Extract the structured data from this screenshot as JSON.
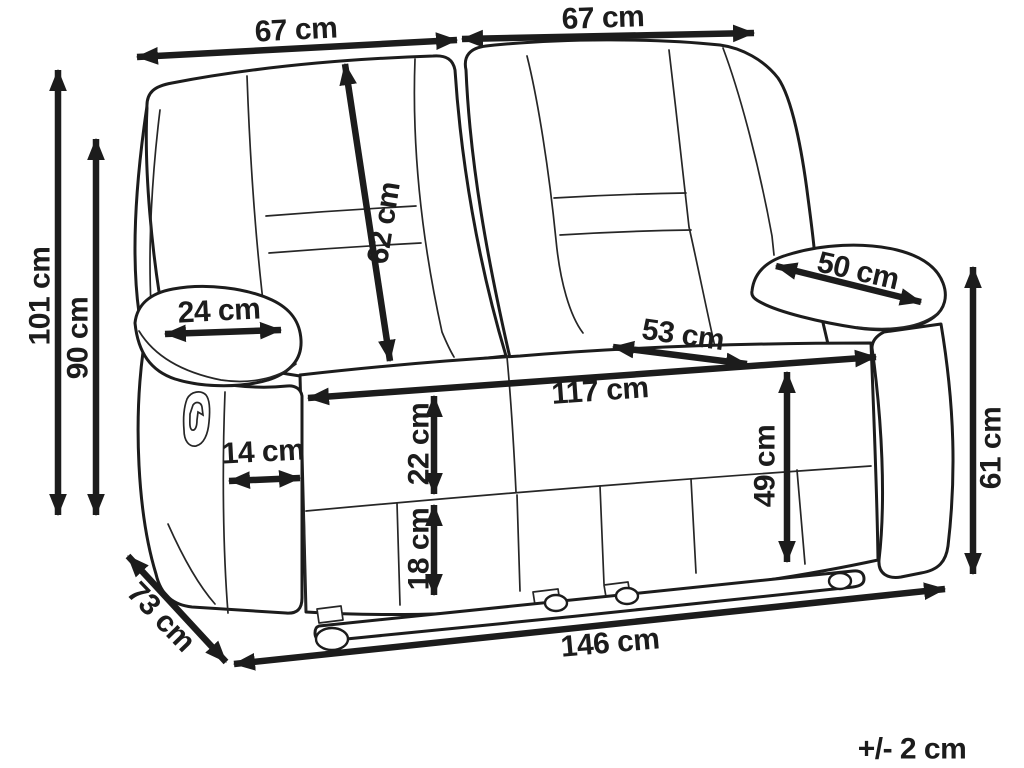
{
  "diagram": {
    "subject": "two-seat recliner sofa dimension drawing",
    "unit": "cm",
    "tolerance_note": "+/- 2 cm",
    "colors": {
      "background": "#ffffff",
      "line": "#1c1c1c"
    },
    "dimensions": [
      {
        "name": "backrest-width-left",
        "label": "67 cm",
        "value": 67,
        "arrow": [
          137,
          57,
          457,
          40
        ],
        "text": [
          296,
          30
        ],
        "rot": -3
      },
      {
        "name": "backrest-width-right",
        "label": "67 cm",
        "value": 67,
        "arrow": [
          462,
          39,
          754,
          33
        ],
        "text": [
          603,
          18
        ],
        "rot": -2
      },
      {
        "name": "total-height",
        "label": "101 cm",
        "value": 101,
        "arrow": [
          58,
          70,
          58,
          515
        ],
        "text": [
          40,
          296
        ],
        "rot": -90
      },
      {
        "name": "backrest-height",
        "label": "90 cm",
        "value": 90,
        "arrow": [
          96,
          139,
          96,
          515
        ],
        "text": [
          78,
          338
        ],
        "rot": -90
      },
      {
        "name": "backrest-cushion-length",
        "label": "62 cm",
        "value": 62,
        "arrow": [
          345,
          64,
          390,
          361
        ],
        "text": [
          384,
          223
        ],
        "rot": -81
      },
      {
        "name": "armrest-pad-width",
        "label": "24 cm",
        "value": 24,
        "arrow": [
          165,
          334,
          281,
          330
        ],
        "text": [
          219,
          311
        ],
        "rot": -3
      },
      {
        "name": "armrest-pad-length",
        "label": "50 cm",
        "value": 50,
        "arrow": [
          776,
          266,
          921,
          302
        ],
        "text": [
          858,
          271
        ],
        "rot": 13
      },
      {
        "name": "seat-depth",
        "label": "53 cm",
        "value": 53,
        "arrow": [
          613,
          347,
          747,
          364
        ],
        "text": [
          683,
          335
        ],
        "rot": 8
      },
      {
        "name": "seat-width",
        "label": "117 cm",
        "value": 117,
        "arrow": [
          308,
          398,
          876,
          357
        ],
        "text": [
          600,
          391
        ],
        "rot": -4
      },
      {
        "name": "seat-height",
        "label": "49 cm",
        "value": 49,
        "arrow": [
          787,
          372,
          787,
          562
        ],
        "text": [
          765,
          466
        ],
        "rot": -90
      },
      {
        "name": "armrest-height",
        "label": "61 cm",
        "value": 61,
        "arrow": [
          973,
          267,
          973,
          574
        ],
        "text": [
          991,
          448
        ],
        "rot": -90
      },
      {
        "name": "seat-cushion-height",
        "label": "22 cm",
        "value": 22,
        "arrow": [
          434,
          396,
          434,
          494
        ],
        "text": [
          419,
          444
        ],
        "rot": -90
      },
      {
        "name": "base-height",
        "label": "18 cm",
        "value": 18,
        "arrow": [
          434,
          505,
          434,
          595
        ],
        "text": [
          419,
          549
        ],
        "rot": -90
      },
      {
        "name": "armrest-front-width",
        "label": "14 cm",
        "value": 14,
        "arrow": [
          229,
          481,
          300,
          478
        ],
        "text": [
          263,
          452
        ],
        "rot": -3
      },
      {
        "name": "overall-depth",
        "label": "73 cm",
        "value": 73,
        "arrow": [
          128,
          556,
          226,
          662
        ],
        "text": [
          161,
          617
        ],
        "rot": 46
      },
      {
        "name": "overall-width",
        "label": "146 cm",
        "value": 146,
        "arrow": [
          234,
          664,
          945,
          589
        ],
        "text": [
          610,
          643
        ],
        "rot": -5
      }
    ]
  }
}
